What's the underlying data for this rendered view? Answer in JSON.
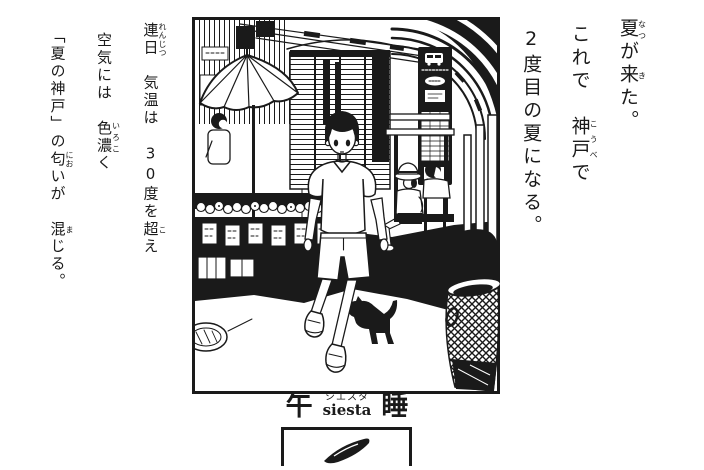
{
  "colors": {
    "ink": "#1a1a1a",
    "paper": "#ffffff"
  },
  "right_text": {
    "col1": {
      "r1b": "夏",
      "r1t": "なつ",
      "t1": "が",
      "r2b": "来",
      "r2t": "き",
      "t2": "た。"
    },
    "col2": {
      "t1": "これで　",
      "r1b": "神戸",
      "r1t": "こうべ",
      "t2": "で"
    },
    "col3": {
      "t1": "2度目の夏になる。"
    }
  },
  "left_text": {
    "col1": {
      "r1b": "連日",
      "r1t": "れんじつ",
      "t1": "　気温は　30度を",
      "r2b": "超",
      "r2t": "こ",
      "t2": "え"
    },
    "col2": {
      "t1": "空気には　",
      "r1b": "色濃",
      "r1t": "いろこ",
      "t2": "く"
    },
    "col3": {
      "t1": "「夏の神戸」の",
      "r1b": "匂",
      "r1t": "にお",
      "t2": "いが　",
      "r2b": "混",
      "r2t": "ま",
      "t3": "じる。"
    }
  },
  "title": {
    "left": "午",
    "kana": "シエスタ",
    "romaji": "siesta",
    "right": "睡"
  },
  "illustration": {
    "scene": "shopping-street-in-summer",
    "elements": [
      "striped-parasol-over-produce-stall",
      "stall-vendor",
      "shuttered-storefronts",
      "arcade-arches",
      "bus-stop-sign",
      "bench-with-two-seated-men",
      "boy-walking-toward-viewer",
      "black-cat",
      "wire-trash-basket",
      "manhole-cover",
      "street-shadow"
    ]
  },
  "bottom_panel": {
    "object": "dark-elongated-object"
  }
}
